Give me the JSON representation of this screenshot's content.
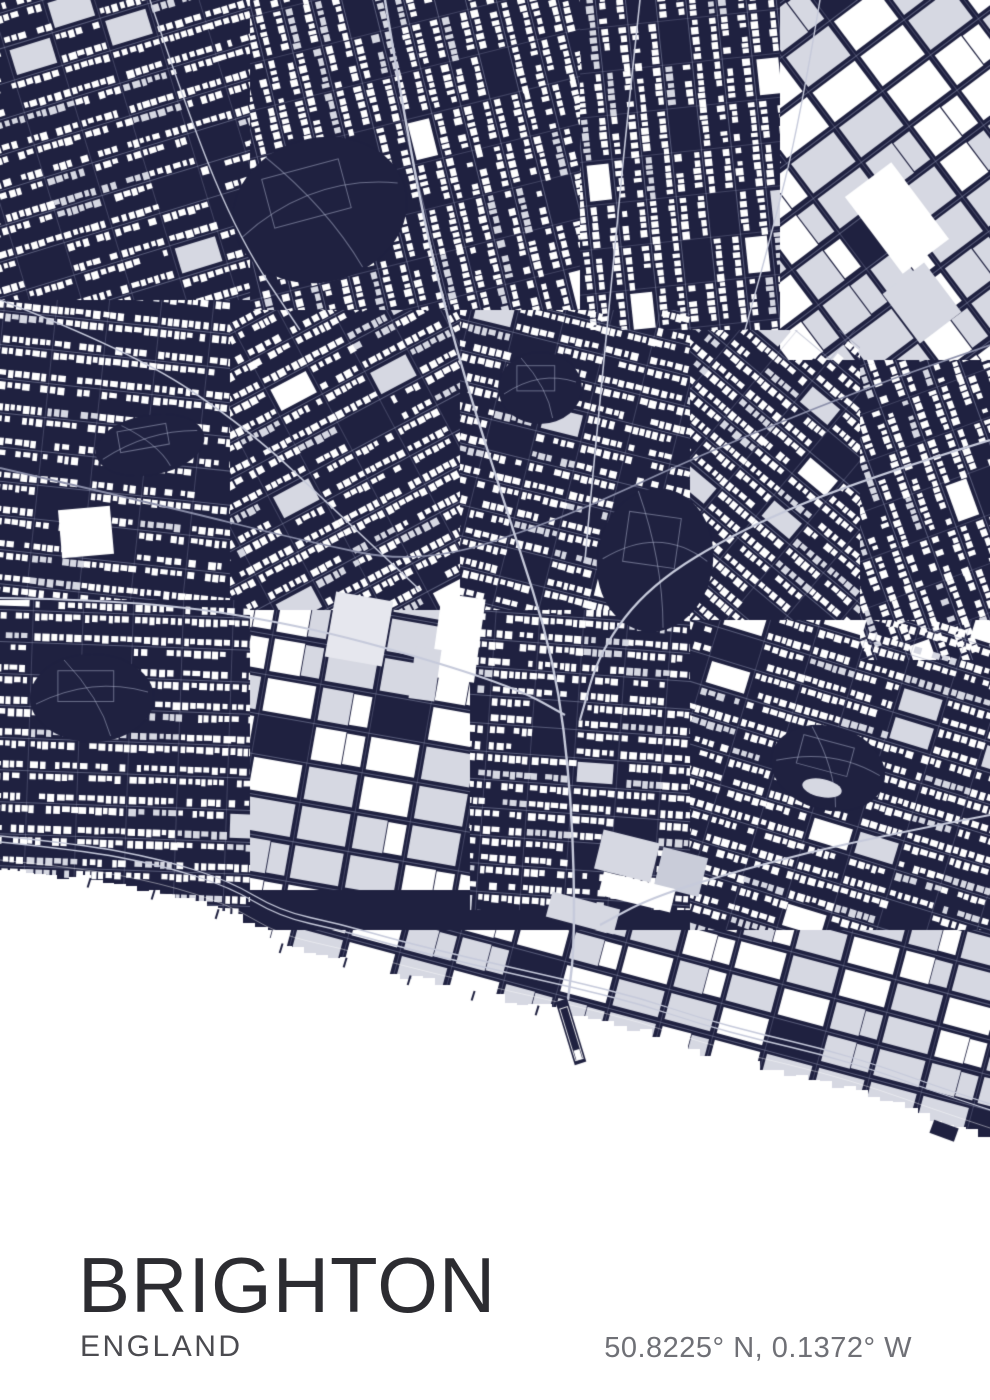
{
  "poster": {
    "title": "BRIGHTON",
    "subtitle": "ENGLAND",
    "coordinates": "50.8225° N, 0.1372° W"
  },
  "map": {
    "type": "city-map",
    "city": "Brighton",
    "region": "England",
    "latitude": "50.8225° N",
    "longitude": "0.1372° W",
    "land_color": "#1f2140",
    "sea_color": "#ffffff",
    "building_color": "#ffffff",
    "building_alt_color": "#d6d8e2",
    "street_color": "#9499b6",
    "road_color": "#c6cadb",
    "rail_color": "#8a8ea9",
    "seed": 11,
    "coastline": [
      [
        0,
        870
      ],
      [
        80,
        878
      ],
      [
        160,
        893
      ],
      [
        230,
        915
      ],
      [
        280,
        945
      ],
      [
        340,
        958
      ],
      [
        400,
        975
      ],
      [
        470,
        992
      ],
      [
        540,
        1008
      ],
      [
        575,
        1016
      ],
      [
        640,
        1032
      ],
      [
        700,
        1052
      ],
      [
        760,
        1068
      ],
      [
        820,
        1082
      ],
      [
        880,
        1100
      ],
      [
        930,
        1118
      ],
      [
        990,
        1138
      ]
    ],
    "pier": {
      "x": 563,
      "y": 1006,
      "angle_deg": 73,
      "length": 60,
      "width": 12
    }
  }
}
